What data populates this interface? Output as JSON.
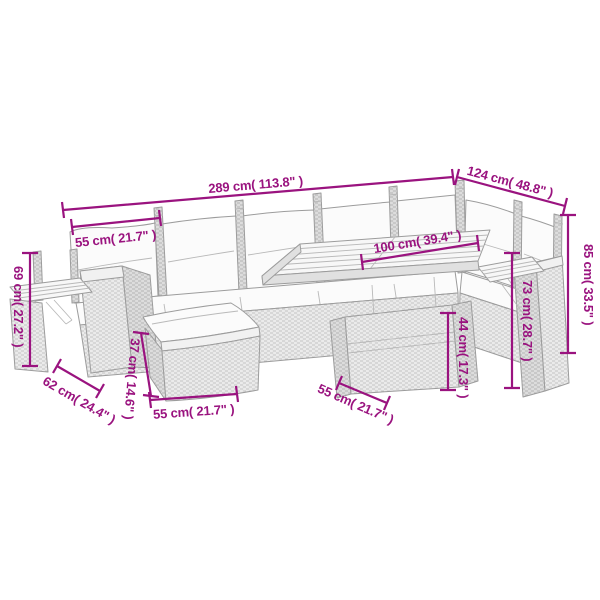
{
  "colors": {
    "accent": "#9A137F",
    "lineart": "#9C9C9C",
    "background": "#FFFFFF"
  },
  "measurements": {
    "total_width": "289 cm( 113.8\" )",
    "total_depth": "124 cm( 48.8\" )",
    "seat_width": "55 cm( 21.7\" )",
    "armrest_shelf_height": "69 cm( 27.2\" )",
    "footstool_depth": "62 cm( 24.4\" )",
    "footstool_height": "37 cm( 14.6\" )",
    "footstool_width": "55 cm( 21.7\" )",
    "table_length": "100 cm( 39.4\" )",
    "table_width": "55 cm( 21.7\" )",
    "table_base_height": "44 cm( 17.3\" )",
    "side_shelf_height": "73 cm( 28.7\" )",
    "backrest_height": "85 cm( 33.5\" )"
  }
}
